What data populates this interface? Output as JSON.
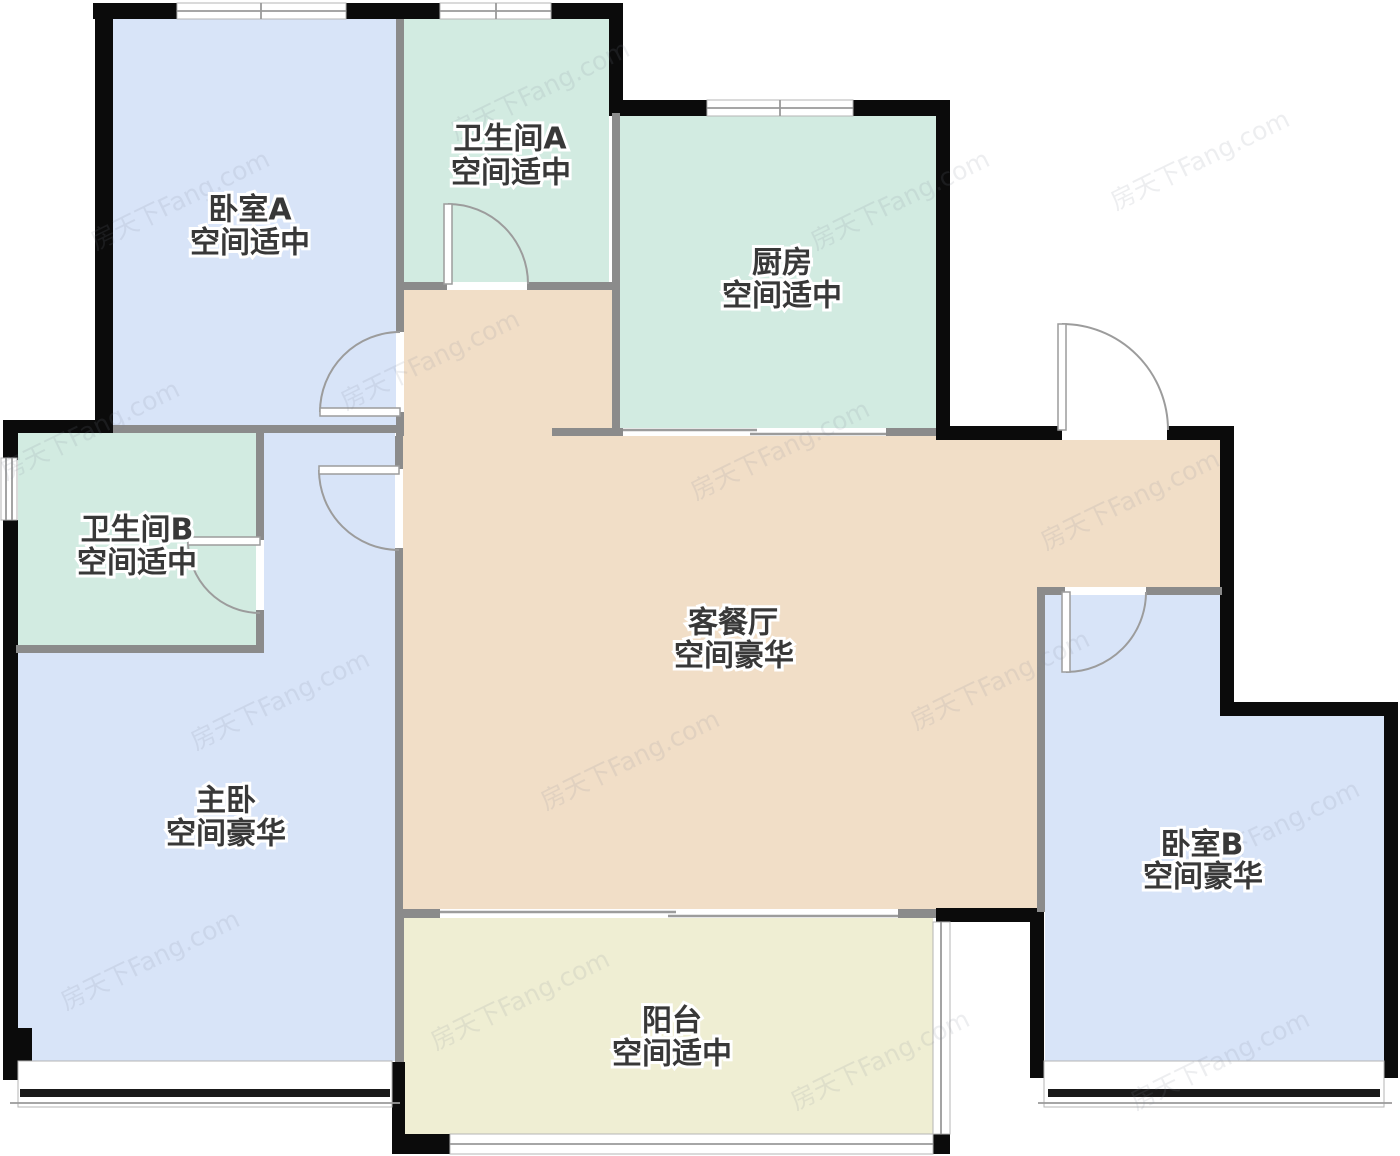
{
  "floorplan": {
    "watermark": "房天下Fang.com",
    "rooms": [
      {
        "id": "bedroom-a",
        "name": "卧室A",
        "status": "空间适中"
      },
      {
        "id": "bathroom-a",
        "name": "卫生间A",
        "status": "空间适中"
      },
      {
        "id": "kitchen",
        "name": "厨房",
        "status": "空间适中"
      },
      {
        "id": "bathroom-b",
        "name": "卫生间B",
        "status": "空间适中"
      },
      {
        "id": "master-bedroom",
        "name": "主卧",
        "status": "空间豪华"
      },
      {
        "id": "living-dining",
        "name": "客餐厅",
        "status": "空间豪华"
      },
      {
        "id": "balcony",
        "name": "阳台",
        "status": "空间适中"
      },
      {
        "id": "bedroom-b",
        "name": "卧室B",
        "status": "空间豪华"
      }
    ],
    "colors": {
      "bedroom": "#d8e4f8",
      "bath_kitchen": "#d2ebe1",
      "living": "#f1dec7",
      "balcony": "#efeed3",
      "exterior_wall": "#0b0b0b",
      "interior_wall": "#8b8b8b"
    }
  }
}
